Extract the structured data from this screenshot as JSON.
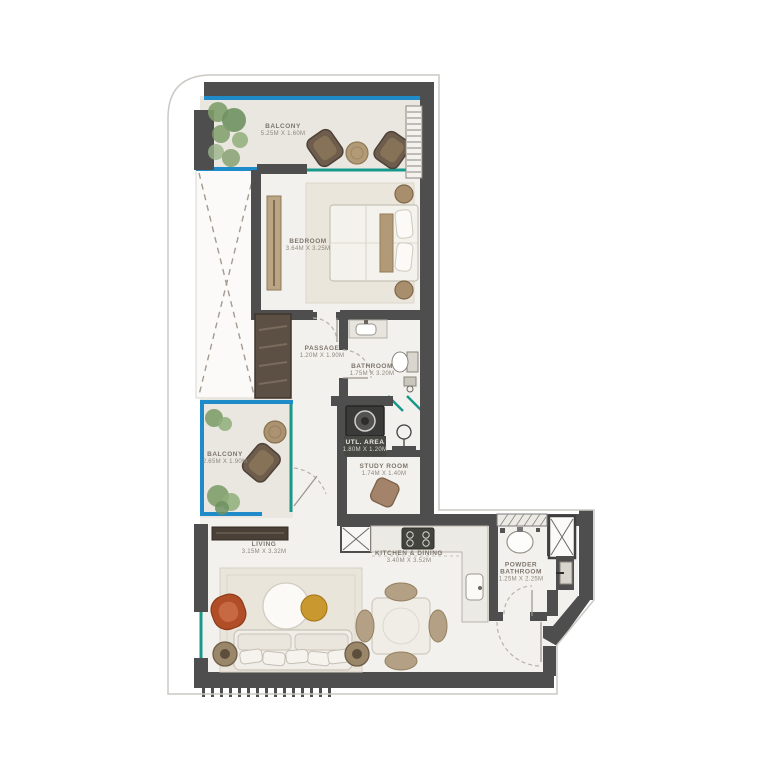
{
  "plan": {
    "type": "residential-floor-plan",
    "rooms": {
      "balcony_top": {
        "name": "BALCONY",
        "dims": "5.25M X 1.60M"
      },
      "bedroom": {
        "name": "BEDROOM",
        "dims": "3.64M X 3.25M"
      },
      "passage": {
        "name": "PASSAGE",
        "dims": "1.20M X 1.90M"
      },
      "bathroom": {
        "name": "BATHROOM",
        "dims": "1.75M X 3.20M"
      },
      "utl_area": {
        "name": "UTL. AREA",
        "dims": "1.80M X 1.20M"
      },
      "study": {
        "name": "STUDY ROOM",
        "dims": "1.74M X 1.40M"
      },
      "balcony_mid": {
        "name": "BALCONY",
        "dims": "2.65M X 1.90M"
      },
      "living": {
        "name": "LIVING",
        "dims": "3.15M X 3.32M"
      },
      "kitchen": {
        "name": "KITCHEN & DINING",
        "dims": "3.40M X 3.52M"
      },
      "powder": {
        "name": "POWDER BATHROOM",
        "dims": "1.25M X 2.25M"
      }
    },
    "colors": {
      "wall": "#4e4e4e",
      "glass_blue": "#1f8cc9",
      "glass_teal": "#18988a",
      "floor_interior": "#f3f1ed",
      "floor_balcony": "#eae7e1",
      "accent_chair": "#b14e27",
      "gold_table": "#c9992f",
      "plant_green": "#7f9d6a",
      "label_text": "#847d73"
    }
  }
}
